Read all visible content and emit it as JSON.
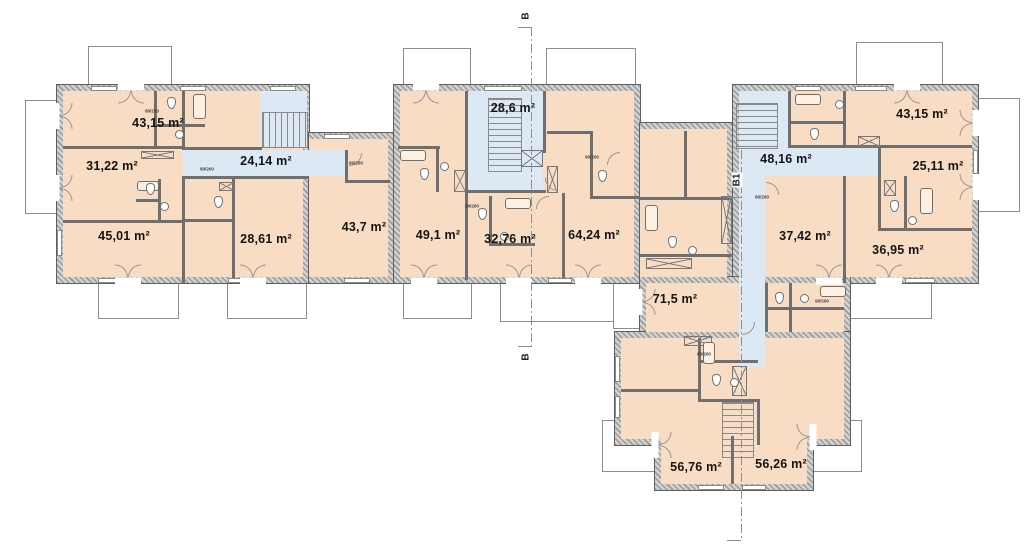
{
  "rooms": [
    {
      "id": "apt-a1",
      "kind": "apartment",
      "area": "43,15 m²"
    },
    {
      "id": "apt-a2",
      "kind": "apartment",
      "area": "31,22 m²"
    },
    {
      "id": "corridor-a",
      "kind": "corridor",
      "area": "24,14 m²"
    },
    {
      "id": "apt-a3",
      "kind": "apartment",
      "area": "45,01 m²"
    },
    {
      "id": "apt-a4",
      "kind": "apartment",
      "area": "28,61 m²"
    },
    {
      "id": "apt-b1",
      "kind": "apartment",
      "area": "43,7 m²"
    },
    {
      "id": "apt-b2",
      "kind": "apartment",
      "area": "49,1 m²"
    },
    {
      "id": "stairwell-b",
      "kind": "stairwell",
      "area": "28,6 m²"
    },
    {
      "id": "apt-b3",
      "kind": "apartment",
      "area": "32,76 m²"
    },
    {
      "id": "apt-b4",
      "kind": "apartment",
      "area": "64,24 m²"
    },
    {
      "id": "corridor-c",
      "kind": "corridor",
      "area": "48,16 m²"
    },
    {
      "id": "apt-c1",
      "kind": "apartment",
      "area": "43,15 m²"
    },
    {
      "id": "apt-c2",
      "kind": "apartment",
      "area": "25,11 m²"
    },
    {
      "id": "apt-c3",
      "kind": "apartment",
      "area": "37,42 m²"
    },
    {
      "id": "apt-c4",
      "kind": "apartment",
      "area": "36,95 m²"
    },
    {
      "id": "apt-d1",
      "kind": "apartment",
      "area": "71,5 m²"
    },
    {
      "id": "apt-d2",
      "kind": "apartment",
      "area": "56,76 m²"
    },
    {
      "id": "apt-d3",
      "kind": "apartment",
      "area": "56,26 m²"
    }
  ],
  "section_markers": {
    "top": "B",
    "bottom": "B",
    "side": "B1"
  },
  "door_tags": {
    "small": "80/200",
    "large": "90/200"
  },
  "colors": {
    "room_fill": "#f8dcc3",
    "circulation_fill": "#dce8f4",
    "wall_hatch": "#9b9b9b",
    "wall_edge": "#5e5e5e",
    "outline": "#8d8d8d"
  }
}
